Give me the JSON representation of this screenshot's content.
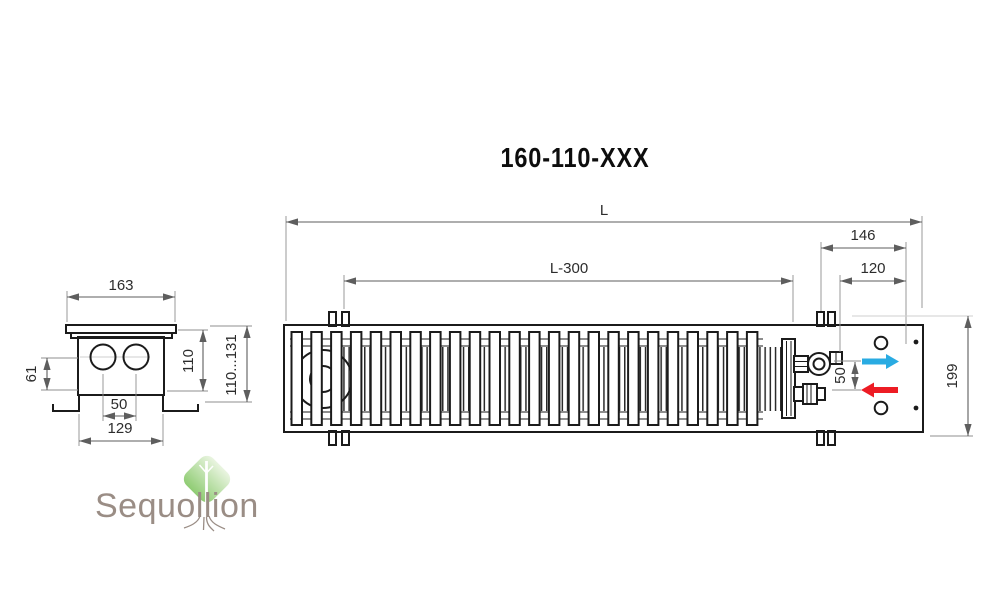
{
  "title": "160-110-XXX",
  "front_view": {
    "label": "front-elevation",
    "dims": {
      "overall_length": "L",
      "grille_length": "L-300",
      "end_section_width": "146",
      "connection_offset": "120",
      "overall_height": "199",
      "pipe_spacing": "50"
    },
    "flow_icons": {
      "inlet": "flow-in-arrow",
      "outlet": "flow-out-arrow"
    }
  },
  "side_view": {
    "label": "end-section",
    "dims": {
      "flange_width": "163",
      "casing_height": "110",
      "pipe_axis_height": "61",
      "pipe_spacing": "50",
      "casing_width": "129",
      "install_height_range": "110...131"
    }
  },
  "logo": {
    "text": "Sequollion",
    "icon": "tree-diamond-icon"
  },
  "colors": {
    "drawing_line": "#1b1b1b",
    "dimension_line": "#5e5e5e",
    "flow_in": "#29abe2",
    "flow_out": "#ed1c24",
    "logo_green_light": "#eaf5e1",
    "logo_green": "#8fcc73",
    "logo_text": "#9a8d85"
  }
}
